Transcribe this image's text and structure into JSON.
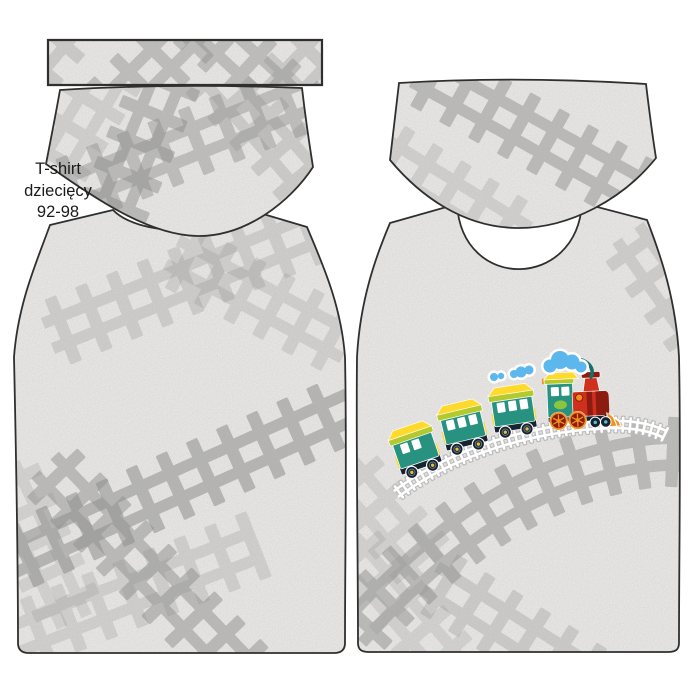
{
  "label": {
    "line1": "T-shirt",
    "line2": "dziecięcy",
    "line3": "92-98"
  },
  "pieces": {
    "count": 5,
    "names": [
      "neckband",
      "sleeve-left",
      "sleeve-right",
      "back-body",
      "front-body"
    ]
  },
  "train": {
    "car_count": 3,
    "cloud_count": 3
  },
  "colors": {
    "fabric": "#edecea",
    "print_gray": "#8f8f8f",
    "outline": "#2f2f2f",
    "teal": "#27927f",
    "teal_dark": "#166e69",
    "light_green": "#8bc53f",
    "yellow": "#ffd92b",
    "lime": "#b4c92e",
    "red": "#d02f1e",
    "dark_red": "#8c1b10",
    "orange": "#f1901e",
    "navy": "#172430",
    "sky_blue": "#5bb7ec",
    "track_white": "#ffffff",
    "text": "#1b1b1b"
  }
}
